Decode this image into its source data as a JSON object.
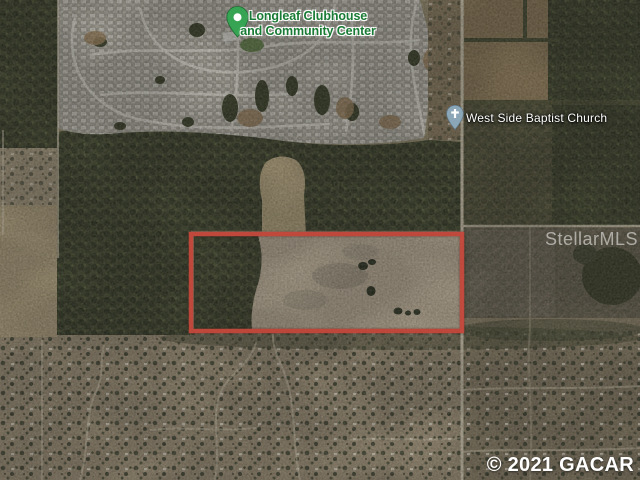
{
  "map": {
    "type": "satellite-photo",
    "poi": [
      {
        "id": "clubhouse",
        "label_line1": "Longleaf Clubhouse",
        "label_line2": "and Community Center",
        "pin": "green-dot-pin"
      },
      {
        "id": "church",
        "label": "West Side Baptist Church",
        "pin": "cross-pin"
      }
    ],
    "parcel_outline": {
      "shape": "rectangle",
      "color": "#c4463a"
    },
    "watermark": "StellarMLS",
    "copyright": "© 2021 GACAR",
    "colors": {
      "poi_label_green": "#187a34",
      "poi_pin_green": "#36a452",
      "church_pin_blue": "#8ba6b7",
      "parcel_red": "#c4463a"
    }
  }
}
